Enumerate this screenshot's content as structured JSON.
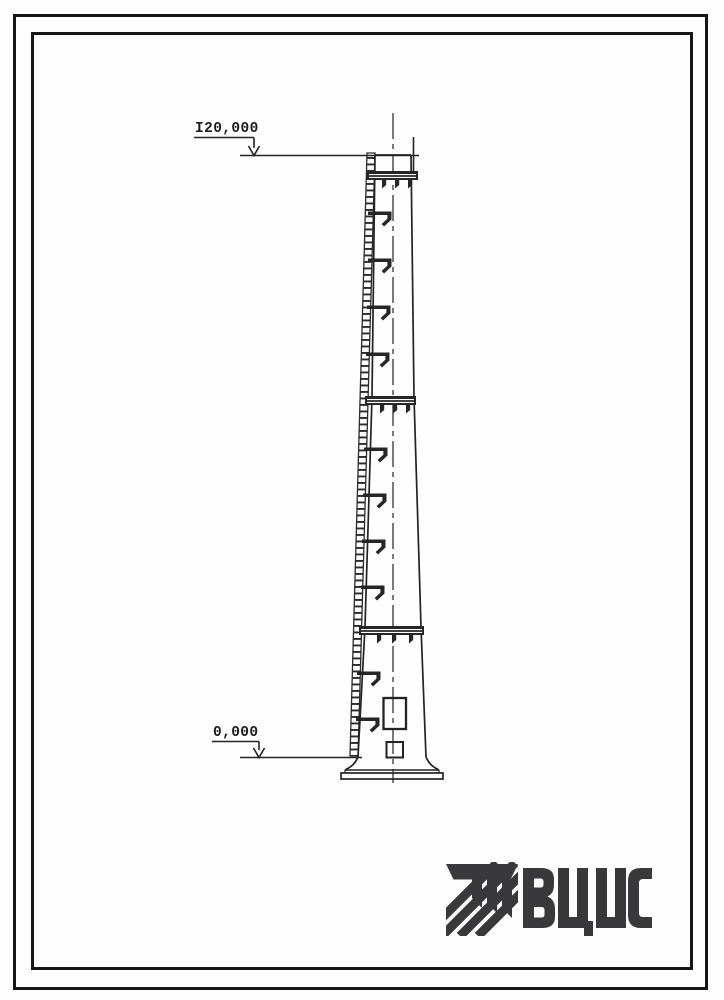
{
  "drawing": {
    "subject": "chimney-elevation-view",
    "elevation_marks": [
      {
        "position": "top",
        "label": "I20,000"
      },
      {
        "position": "bottom",
        "label": "0,000"
      }
    ],
    "logo": {
      "text": "ВЦИС"
    },
    "colors": {
      "ink": "#232323",
      "logo": "#39393b",
      "paper": "#fdfdfd"
    }
  }
}
